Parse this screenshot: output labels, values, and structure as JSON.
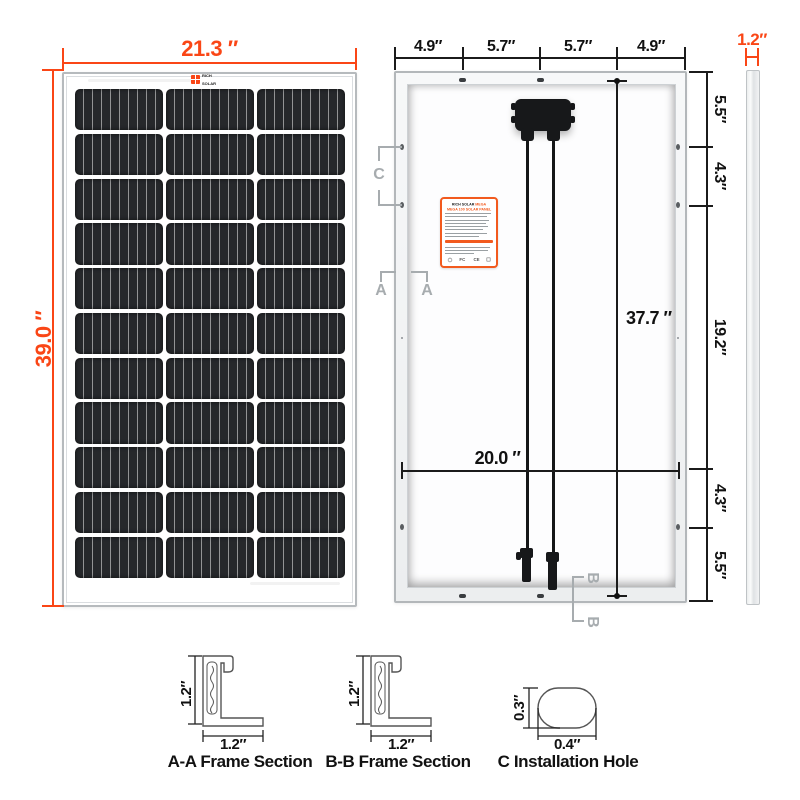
{
  "diagram": {
    "colors": {
      "accent": "#FA4616",
      "line": "#1b1b1b",
      "marker": "#a7acaf"
    },
    "front": {
      "width_dim": "21.3 ″",
      "height_dim": "39.0 ″",
      "brand_line1": "RICH",
      "brand_line2": "SOLAR",
      "grid": {
        "rows": 11,
        "cols": 3
      }
    },
    "back": {
      "top_dims": [
        "4.9″",
        "5.7″",
        "5.7″",
        "4.9″"
      ],
      "right_dims": [
        "5.5″",
        "4.3″",
        "19.2″",
        "4.3″",
        "5.5″"
      ],
      "inner_height_dim": "37.7 ″",
      "inner_width_dim": "20.0 ″",
      "marker_c": "C",
      "marker_a": "A",
      "marker_b": "B",
      "sticker": {
        "brand": "RICH SOLAR",
        "model": "MEGA",
        "title": "MEGA 100 SOLAR PANEL",
        "certs": [
          "FC",
          "CE"
        ]
      }
    },
    "side": {
      "thickness_dim": "1.2″"
    },
    "sections": {
      "aa": {
        "title": "A-A Frame Section",
        "height_dim": "1.2″",
        "width_dim": "1.2″"
      },
      "bb": {
        "title": "B-B Frame Section",
        "height_dim": "1.2″",
        "width_dim": "1.2″"
      },
      "c": {
        "title": "C Installation Hole",
        "height_dim": "0.3″",
        "width_dim": "0.4″"
      }
    }
  }
}
